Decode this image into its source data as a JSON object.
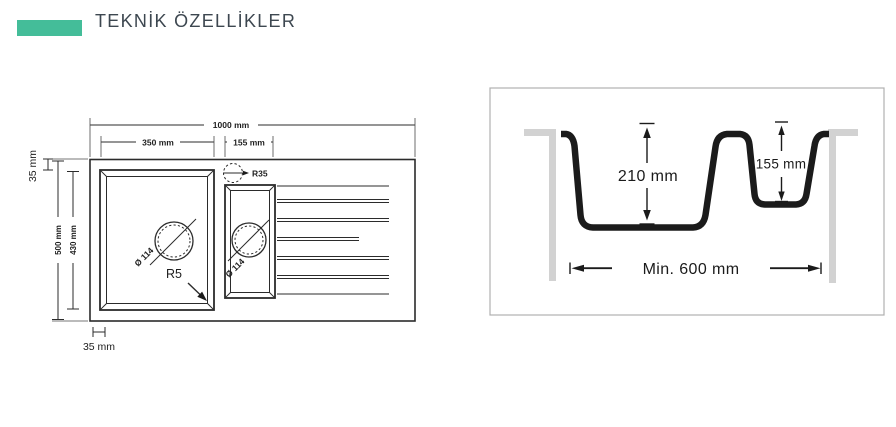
{
  "header": {
    "title": "TEKNİK ÖZELLİKLER"
  },
  "top_view": {
    "overall_width": "1000 mm",
    "main_bowl_width": "350 mm",
    "half_bowl_width": "155 mm",
    "overall_depth": "500 mm",
    "bowl_depth": "430 mm",
    "top_margin": "35 mm",
    "left_margin": "35 mm",
    "main_drain": "Ø 114",
    "half_drain": "Ø 114",
    "corner_radius": "R5",
    "drain_radius": "R35"
  },
  "section_view": {
    "main_depth": "210 mm",
    "half_depth": "155 mm",
    "min_cabinet": "Min. 600 mm"
  },
  "colors": {
    "accent": "#44BD99",
    "title_text": "#3d4750",
    "drawing_line": "#2b2b2b",
    "section_profile": "#1b1b1b",
    "cabinet_wall": "#d2d2d2",
    "panel_border": "#b0b0b0"
  }
}
